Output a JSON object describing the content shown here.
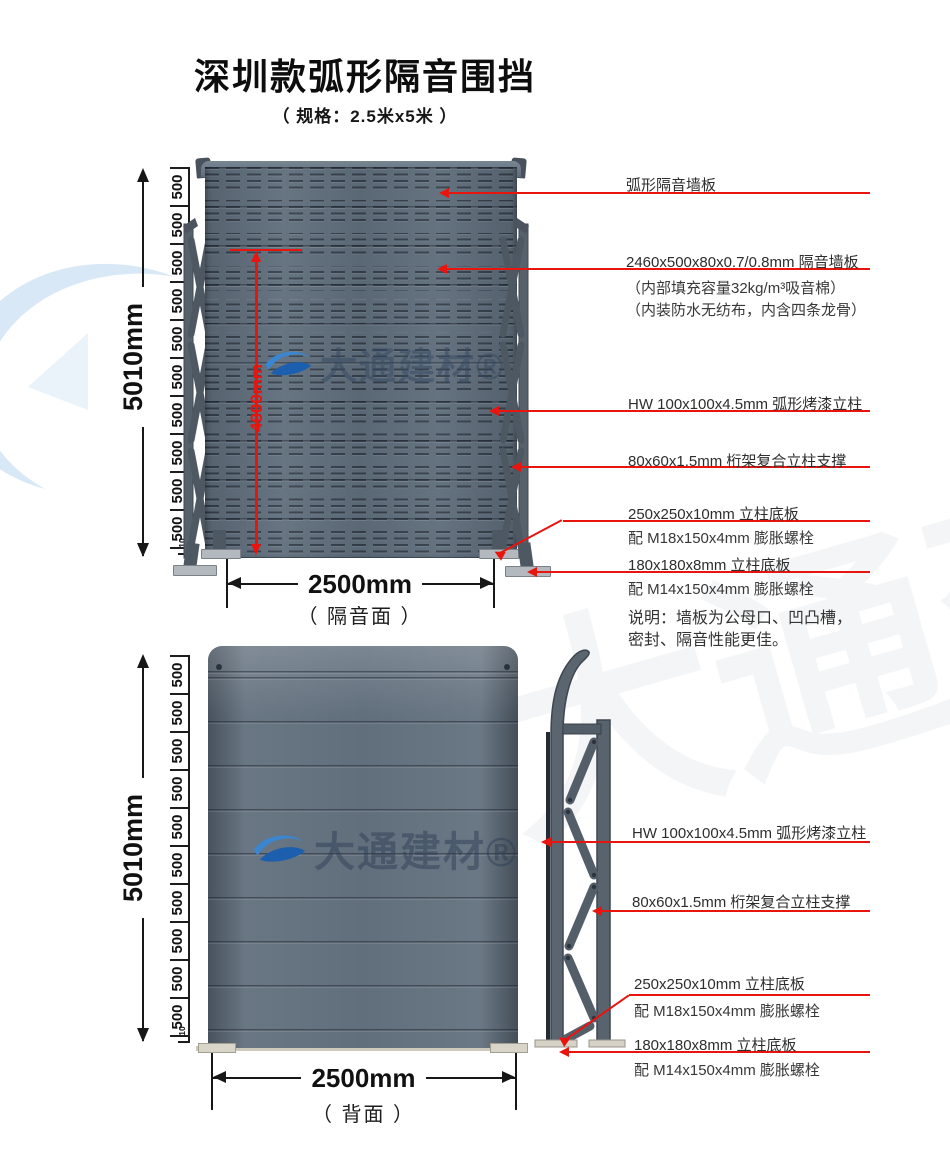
{
  "page": {
    "title": "深圳款弧形隔音围挡",
    "subtitle": "（ 规格：2.5米x5米 ）"
  },
  "brand": {
    "watermark_text": "大通建材®"
  },
  "colors": {
    "accent_red": "#e8150f",
    "panel_slate": "#5f6d7b",
    "steel_gray": "#57616b"
  },
  "front": {
    "overall_height": "5010mm",
    "segment_label": "500",
    "segment_count": 10,
    "bottom_segment": "10",
    "inner_height": "4000mm",
    "width": "2500mm",
    "caption": "（ 隔音面 ）",
    "callouts": [
      {
        "label": "弧形隔音墙板"
      },
      {
        "label": "2460x500x80x0.7/0.8mm 隔音墙板",
        "sub1": "（内部填充容量32kg/m³吸音棉）",
        "sub2": "（内装防水无纺布，内含四条龙骨）"
      },
      {
        "label": "HW 100x100x4.5mm 弧形烤漆立柱"
      },
      {
        "label": "80x60x1.5mm 桁架复合立柱支撑"
      },
      {
        "label": "250x250x10mm 立柱底板",
        "sub1": "配 M18x150x4mm 膨胀螺栓"
      },
      {
        "label": "180x180x8mm 立柱底板",
        "sub1": "配 M14x150x4mm 膨胀螺栓"
      }
    ],
    "note_line1": "说明：墙板为公母口、凹凸槽，",
    "note_line2": "密封、隔音性能更佳。"
  },
  "back": {
    "overall_height": "5010mm",
    "segment_label": "500",
    "segment_count": 10,
    "bottom_segment": "10",
    "width": "2500mm",
    "caption": "（ 背面 ）",
    "callouts": [
      {
        "label": "HW 100x100x4.5mm 弧形烤漆立柱"
      },
      {
        "label": "80x60x1.5mm 桁架复合立柱支撑"
      },
      {
        "label": "250x250x10mm 立柱底板",
        "sub1": "配 M18x150x4mm 膨胀螺栓"
      },
      {
        "label": "180x180x8mm 立柱底板",
        "sub1": "配 M14x150x4mm 膨胀螺栓"
      }
    ]
  }
}
